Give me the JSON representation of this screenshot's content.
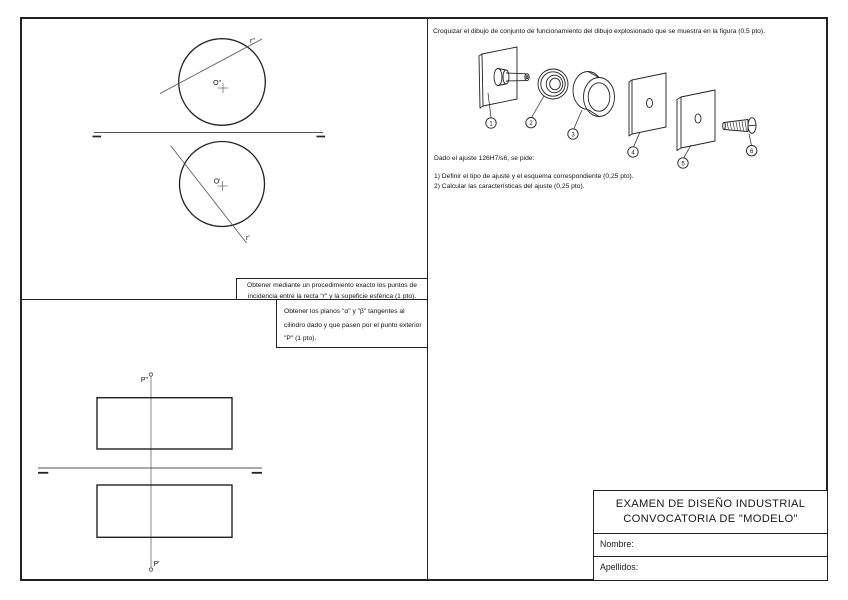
{
  "sphere_panel": {
    "task": "Obtener mediante un procedimiento exacto los puntos de incidencia entre la recta \"r\" y la supeficie esférica (1 pto).",
    "labels": {
      "r2": "r\"",
      "r1": "r'",
      "o2": "O\"",
      "o1": "O'"
    }
  },
  "cylinder_panel": {
    "task": "Obtener los planos \"α\" y \"β\" tangentes al cilindro dado y que pasen por el punto exterior \"P\" (1 pto).",
    "labels": {
      "p2": "P\"",
      "p1": "P'"
    }
  },
  "assembly_panel": {
    "task": "Croquizar el dibujo de conjunto de funcionamiento del dibujo explosionado que se muestra en la figura  (0,5 pto).",
    "fit_intro": "Dado el ajuste 126H7/s6, se pide:",
    "fit_item1": "1) Definir el tipo de ajuste y el esquema correspondiente (0,25 pto).",
    "fit_item2": "2) Calcular las características del ajuste (0,25 pto).",
    "balloons": [
      "1",
      "2",
      "3",
      "4",
      "5",
      "6"
    ]
  },
  "title_block": {
    "title_line1": "EXAMEN DE DISEÑO INDUSTRIAL",
    "title_line2": "CONVOCATORIA DE \"MODELO\"",
    "name_label": "Nombre:",
    "surname_label": "Apellidos:"
  },
  "colors": {
    "line": "#1f1f1f",
    "construction": "#555555",
    "background": "#ffffff"
  }
}
